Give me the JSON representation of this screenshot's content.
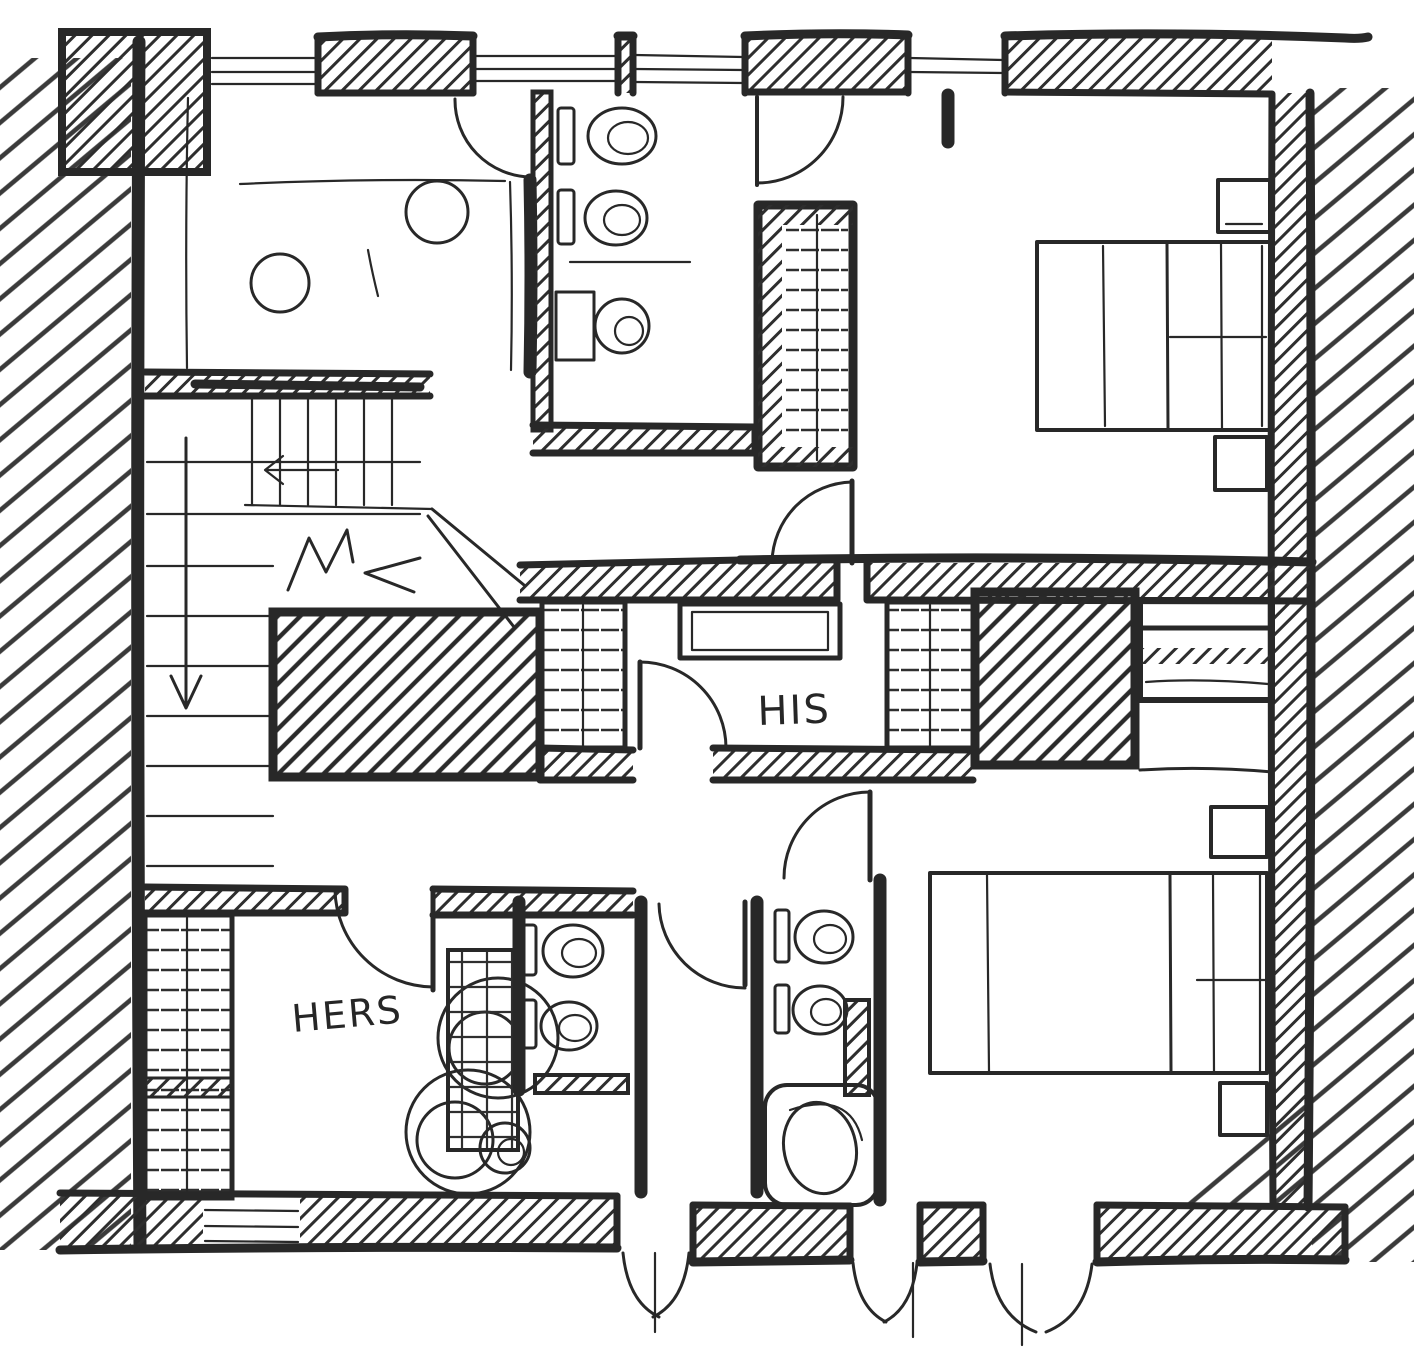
{
  "colors": {
    "ink": "#282828",
    "paper": "#ffffff"
  },
  "labels": {
    "his": {
      "text": "HIS"
    },
    "hers": {
      "text": "HERS"
    }
  },
  "sketch": {
    "kind": "hand-drawn floor plan (marker sketch)",
    "drawn_elements": [
      "hatched exterior walls",
      "five windows",
      "staircase with down arrow and break line",
      "hatched floor voids",
      "his walk-in closet with hanging rods and island",
      "hers closet with shelving",
      "three bathrooms with toilets and sinks",
      "bathtub",
      "two bedrooms with beds and nightstands",
      "interior swing doors",
      "three french/patio door openings"
    ]
  }
}
